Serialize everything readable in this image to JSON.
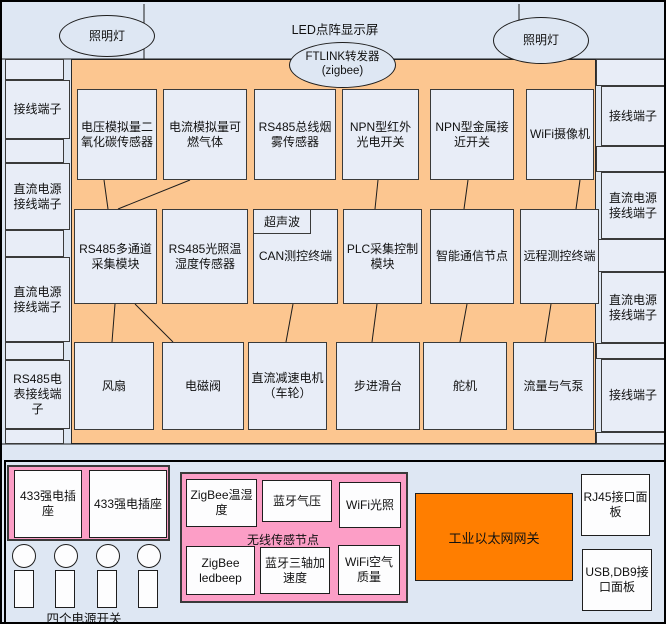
{
  "title": "LED点阵显示屏",
  "lamps": {
    "left": "照明灯",
    "right": "照明灯"
  },
  "ftlink": "FTLINK转发器\n(zigbee)",
  "left_column": [
    "接线端子",
    "直流电源接线端子",
    "直流电源接线端子",
    "RS485电表接线端子"
  ],
  "right_column": [
    "接线端子",
    "直流电源接线端子",
    "直流电源接线端子",
    "接线端子"
  ],
  "grid": {
    "row1": [
      "电压模拟量二氧化碳传感器",
      "电流模拟量可燃气体",
      "RS485总线烟雾传感器",
      "NPN型红外光电开关",
      "NPN型金属接近开关",
      "WiFi摄像机"
    ],
    "row2": [
      "RS485多通道采集模块",
      "RS485光照温湿度传感器",
      "CAN测控终端",
      "PLC采集控制模块",
      "智能通信节点",
      "远程测控终端"
    ],
    "ultrasonic_tag": "超声波",
    "row3": [
      "风扇",
      "电磁阀",
      "直流减速电机（车轮）",
      "步进滑台",
      "舵机",
      "流量与气泵"
    ]
  },
  "bottom": {
    "sockets": [
      "433强电插座",
      "433强电插座"
    ],
    "switches_label": "四个电源开关",
    "wireless_label": "无线传感节点",
    "wireless_nodes": [
      "ZigBee温湿度",
      "蓝牙气压",
      "WiFi光照",
      "ZigBee ledbeep",
      "蓝牙三轴加速度",
      "WiFi空气质量"
    ],
    "gateway": "工业以太网网关",
    "rj45_panel": "RJ45接口面板",
    "usb_panel": "USB,DB9接口面板"
  },
  "colors": {
    "background": "#dee7f3",
    "main_panel_orange": "#fcc690",
    "wireless_pink": "#fc9ec6",
    "gateway_orange": "#ff7e00",
    "box_fill": "#e8edf7"
  }
}
